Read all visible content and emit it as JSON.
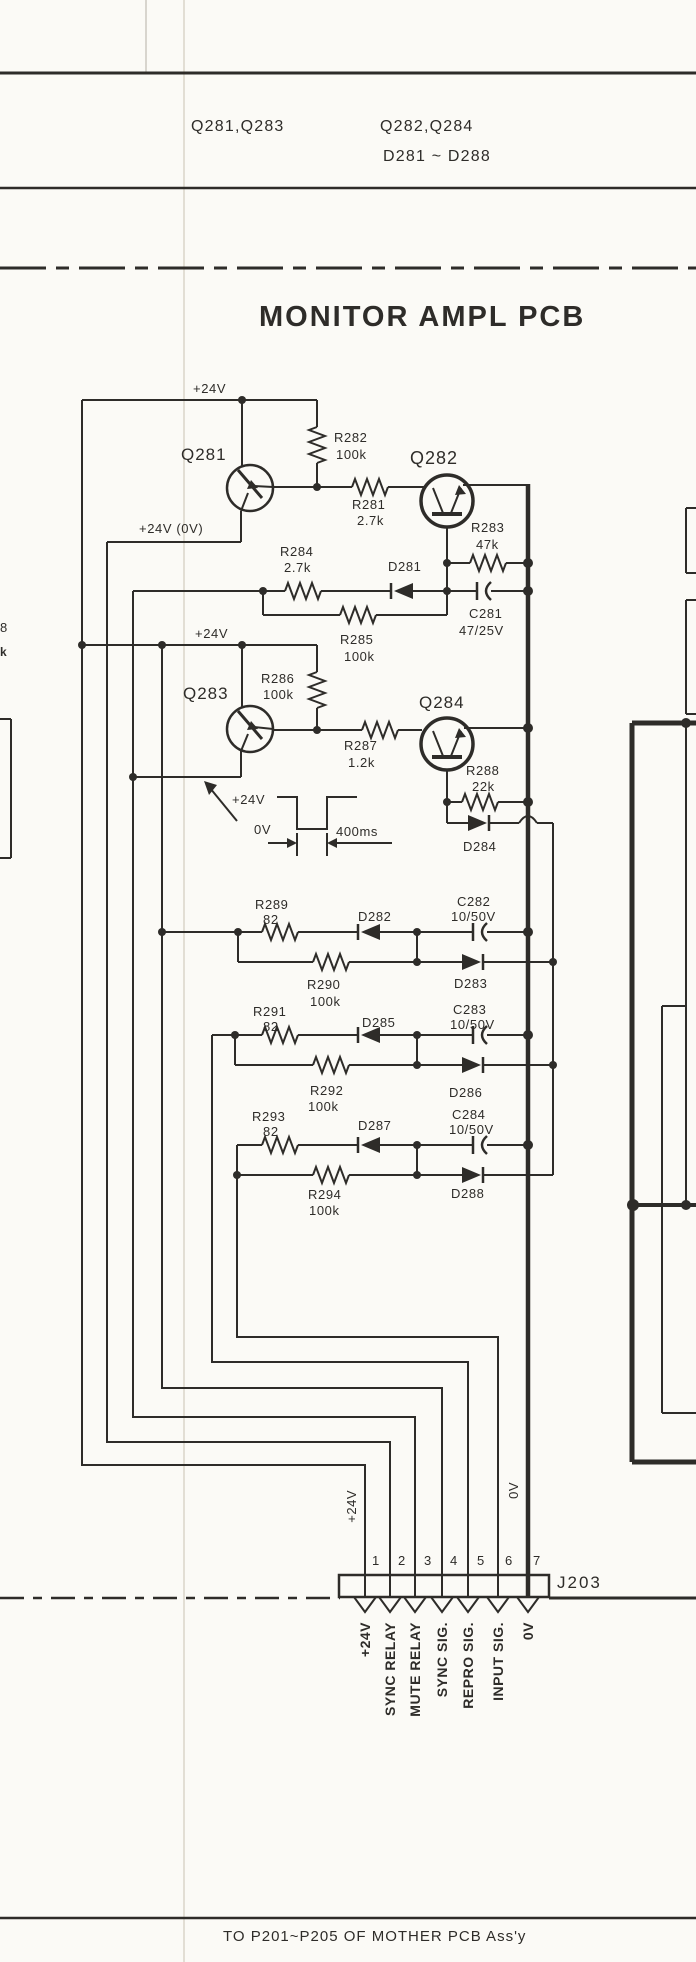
{
  "header": {
    "group1": "Q281,Q283",
    "group2": "Q282,Q284",
    "group3": "D281 ~ D288"
  },
  "title": {
    "text": "MONITOR AMPL PCB"
  },
  "labels": {
    "rail_top": "+24V",
    "rail_mid": "+24V (0V)",
    "rail2": "+24V"
  },
  "pulse": {
    "high": "+24V",
    "low": "0V",
    "width": "400ms"
  },
  "transistors": {
    "q281": "Q281",
    "q282": "Q282",
    "q283": "Q283",
    "q284": "Q284"
  },
  "resistors": {
    "r281": {
      "ref": "R281",
      "value": "2.7k"
    },
    "r282": {
      "ref": "R282",
      "value": "100k"
    },
    "r283": {
      "ref": "R283",
      "value": "47k"
    },
    "r284": {
      "ref": "R284",
      "value": "2.7k"
    },
    "r285": {
      "ref": "R285",
      "value": "100k"
    },
    "r286": {
      "ref": "R286",
      "value": "100k"
    },
    "r287": {
      "ref": "R287",
      "value": "1.2k"
    },
    "r288": {
      "ref": "R288",
      "value": "22k"
    },
    "r289": {
      "ref": "R289",
      "value": "82"
    },
    "r290": {
      "ref": "R290",
      "value": "100k"
    },
    "r291": {
      "ref": "R291",
      "value": "82"
    },
    "r292": {
      "ref": "R292",
      "value": "100k"
    },
    "r293": {
      "ref": "R293",
      "value": "82"
    },
    "r294": {
      "ref": "R294",
      "value": "100k"
    }
  },
  "capacitors": {
    "c281": {
      "ref": "C281",
      "value": "47/25V"
    },
    "c282": {
      "ref": "C282",
      "value": "10/50V"
    },
    "c283": {
      "ref": "C283",
      "value": "10/50V"
    },
    "c284": {
      "ref": "C284",
      "value": "10/50V"
    }
  },
  "diodes": {
    "d281": "D281",
    "d282": "D282",
    "d283": "D283",
    "d284": "D284",
    "d285": "D285",
    "d286": "D286",
    "d287": "D287",
    "d288": "D288"
  },
  "connector": {
    "ref": "J203",
    "pins": [
      "1",
      "2",
      "3",
      "4",
      "5",
      "6",
      "7"
    ],
    "pin_labels": [
      "+24V",
      "SYNC RELAY",
      "MUTE RELAY",
      "SYNC SIG.",
      "REPRO SIG.",
      "INPUT SIG.",
      "0V"
    ],
    "rail_plus24": "+24V",
    "rail_0v": "0V"
  },
  "fragments": {
    "f1": "8",
    "f2": "k"
  },
  "footer": {
    "note": "TO P201~P205 OF MOTHER PCB Ass'y"
  }
}
